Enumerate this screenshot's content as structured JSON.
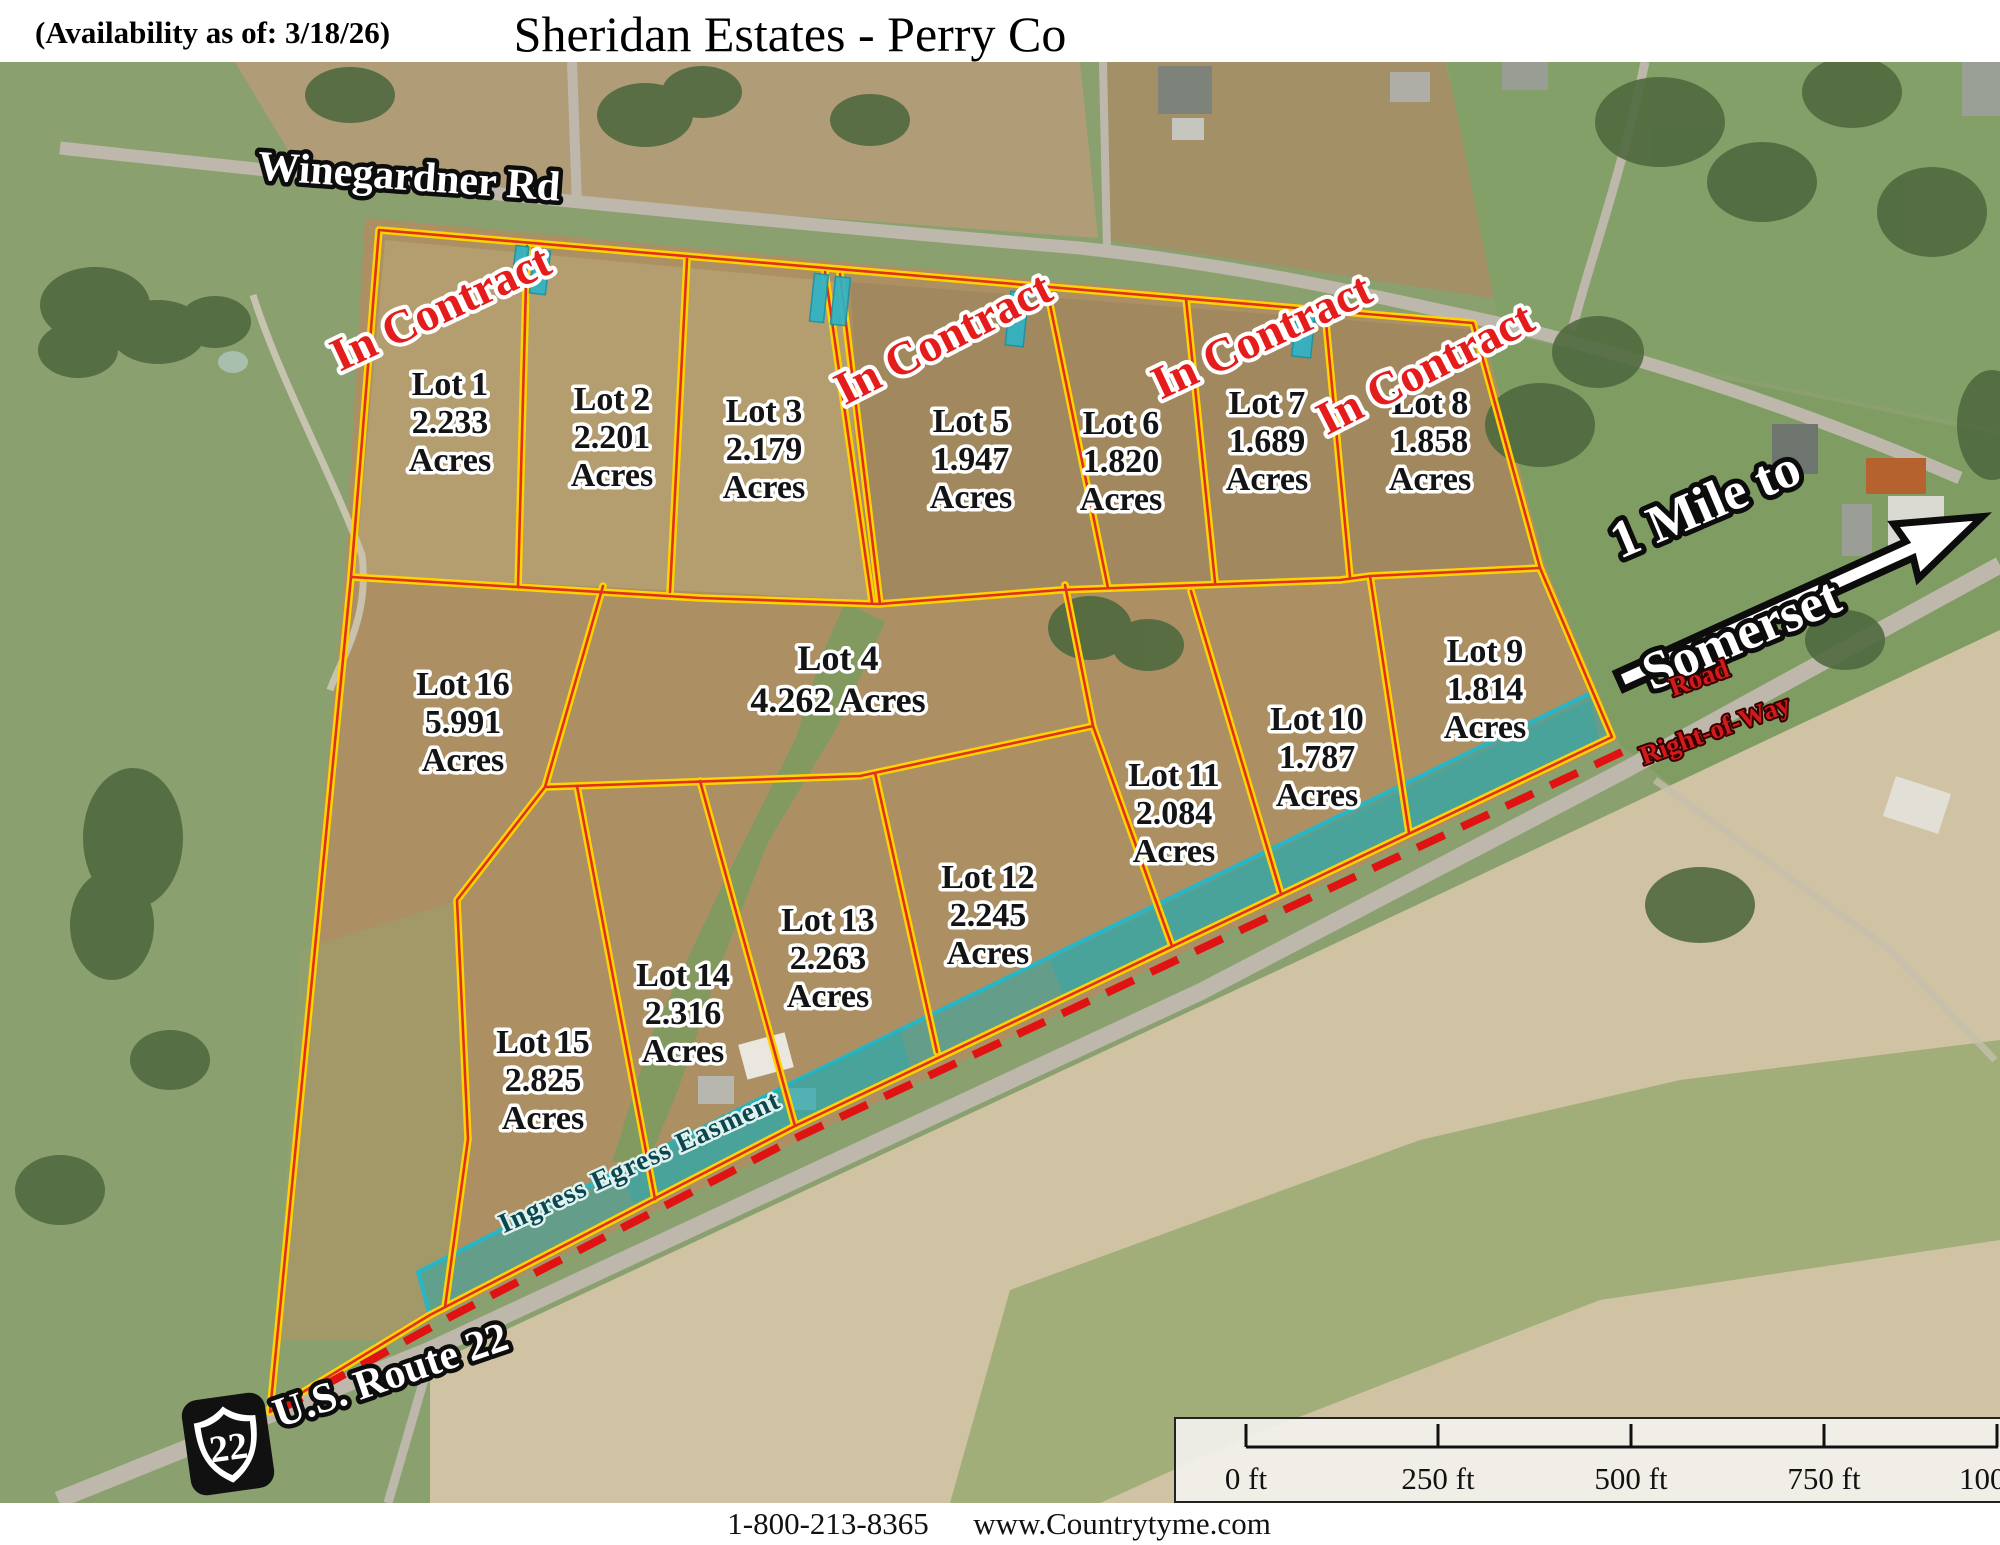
{
  "header": {
    "availability_note": "(Availability as of: 3/18/26)",
    "title": "Sheridan Estates - Perry Co"
  },
  "map": {
    "road_labels": {
      "winegardner_rd": "Winegardner Rd",
      "us_route_22": "U.S. Route 22",
      "route_shield_number": "22"
    },
    "annotations": {
      "in_contract": "In Contract",
      "somerset_arrow_line1": "1 Mile to",
      "somerset_arrow_line2": "Somerset",
      "right_of_way_line1": "Road",
      "right_of_way_line2": "Right-of-Way",
      "easement_label": "Ingress Egress Easment"
    },
    "acres_word": "Acres",
    "lots": [
      {
        "name": "Lot 1",
        "acreage": "2.233",
        "in_contract": true
      },
      {
        "name": "Lot 2",
        "acreage": "2.201",
        "in_contract": false
      },
      {
        "name": "Lot 3",
        "acreage": "2.179",
        "in_contract": false
      },
      {
        "name": "Lot 5",
        "acreage": "1.947",
        "in_contract": true
      },
      {
        "name": "Lot 6",
        "acreage": "1.820",
        "in_contract": false
      },
      {
        "name": "Lot 7",
        "acreage": "1.689",
        "in_contract": true
      },
      {
        "name": "Lot 8",
        "acreage": "1.858",
        "in_contract": true
      },
      {
        "name": "Lot 9",
        "acreage": "1.814",
        "in_contract": false
      },
      {
        "name": "Lot 10",
        "acreage": "1.787",
        "in_contract": false
      },
      {
        "name": "Lot 11",
        "acreage": "2.084",
        "in_contract": false
      },
      {
        "name": "Lot 12",
        "acreage": "2.245",
        "in_contract": false
      },
      {
        "name": "Lot 13",
        "acreage": "2.263",
        "in_contract": false
      },
      {
        "name": "Lot 14",
        "acreage": "2.316",
        "in_contract": false
      },
      {
        "name": "Lot 15",
        "acreage": "2.825",
        "in_contract": false
      },
      {
        "name": "Lot 16",
        "acreage": "5.991",
        "in_contract": false
      }
    ],
    "lot4": {
      "name": "Lot 4",
      "acreage_line": "4.262 Acres"
    },
    "scale_bar": {
      "tick_labels": [
        "0 ft",
        "250 ft",
        "500 ft",
        "750 ft",
        "1000"
      ]
    },
    "colors": {
      "lot_line_yellow": "#ffd400",
      "lot_line_red": "#e03020",
      "in_contract_red": "#e51c1c",
      "easement_teal": "#2aa9ad",
      "right_of_way_red": "#d21a1a"
    }
  },
  "footer": {
    "phone": "1-800-213-8365",
    "website": "www.Countrytyme.com"
  }
}
